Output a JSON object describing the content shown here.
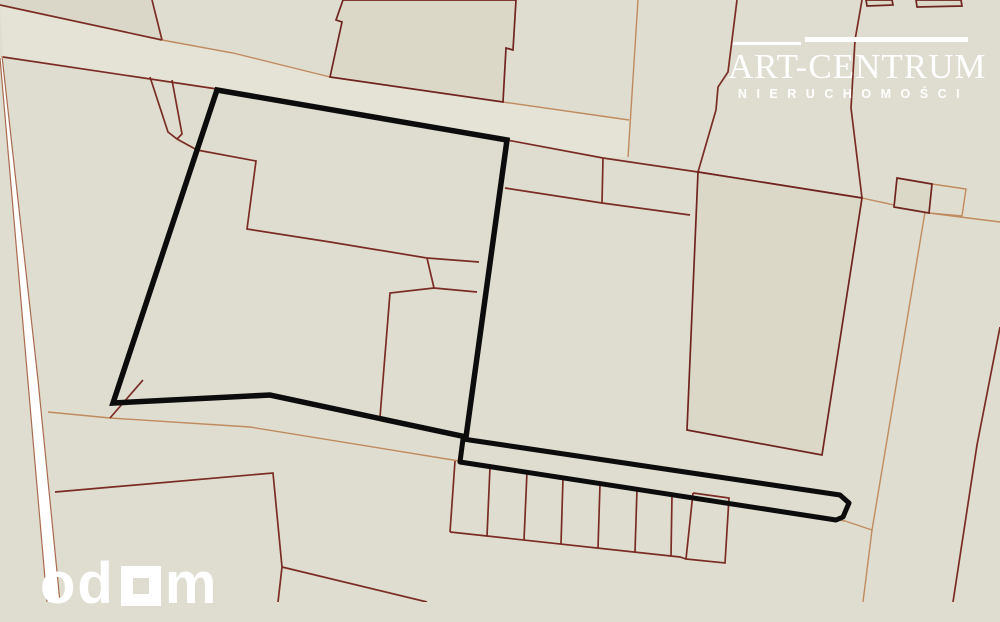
{
  "watermarks": {
    "brand": {
      "title": "ART-CENTRUM",
      "subtitle": "NIERUCHOMOŚCI"
    },
    "portal": {
      "prefix": "od",
      "suffix": "m"
    }
  },
  "map": {
    "canvas": {
      "width": 1000,
      "height": 602
    },
    "colors": {
      "background": "#dfddcf",
      "parcel_dark_line": "#7a2c24",
      "building_line": "#6f241f",
      "building_fill": "#dbd8c7",
      "tan_line": "#c08a5f",
      "road_white": "#ffffff",
      "road_edge": "#a96a4f",
      "highlight": "#0c0c0c",
      "parcel_fill_dark": "#dad7c8",
      "road_band_fill": "#e5e3d5"
    },
    "fills": [
      {
        "name": "parcel-topleft-fill",
        "fill": "#dad7c8",
        "pts": [
          [
            0,
            0
          ],
          [
            152,
            0
          ],
          [
            162,
            40
          ],
          [
            0,
            5
          ]
        ]
      },
      {
        "name": "road-band-fill",
        "fill": "#e5e3d5",
        "pts": [
          [
            0,
            5
          ],
          [
            162,
            40
          ],
          [
            233,
            53
          ],
          [
            330,
            77
          ],
          [
            503,
            102
          ],
          [
            629,
            120
          ],
          [
            628,
            157
          ],
          [
            603,
            158
          ],
          [
            507,
            140
          ],
          [
            217,
            89
          ],
          [
            3,
            57
          ]
        ]
      }
    ],
    "white_road": {
      "fill_pts": [
        [
          0,
          58
        ],
        [
          2,
          56
        ],
        [
          38,
          380
        ],
        [
          60,
          602
        ],
        [
          47,
          602
        ],
        [
          28,
          382
        ]
      ],
      "edges": [
        {
          "name": "white-road-edge-right",
          "pts": [
            [
              2,
              56
            ],
            [
              38,
              380
            ],
            [
              60,
              602
            ]
          ]
        },
        {
          "name": "white-road-edge-left",
          "pts": [
            [
              0,
              58
            ],
            [
              28,
              382
            ],
            [
              47,
              602
            ]
          ]
        }
      ]
    },
    "tan_lines": [
      {
        "name": "road-upper-edge-west",
        "pts": [
          [
            162,
            40
          ],
          [
            233,
            53
          ],
          [
            330,
            77
          ]
        ]
      },
      {
        "name": "road-upper-edge-east",
        "pts": [
          [
            503,
            102
          ],
          [
            629,
            120
          ]
        ]
      },
      {
        "name": "north-vertical-divider",
        "pts": [
          [
            638,
            0
          ],
          [
            628,
            157
          ]
        ]
      },
      {
        "name": "block-top-line-east",
        "pts": [
          [
            862,
            198
          ],
          [
            894,
            205
          ],
          [
            929,
            213
          ],
          [
            1000,
            222
          ]
        ]
      },
      {
        "name": "east-parcel-divider",
        "pts": [
          [
            925,
            212
          ],
          [
            887,
            440
          ],
          [
            872,
            530
          ],
          [
            863,
            602
          ]
        ]
      },
      {
        "name": "strip-end-connector",
        "pts": [
          [
            845,
            521
          ],
          [
            872,
            530
          ]
        ]
      },
      {
        "name": "south-road-line",
        "pts": [
          [
            48,
            412
          ],
          [
            110,
            418
          ],
          [
            250,
            427
          ],
          [
            453,
            460
          ],
          [
            845,
            521
          ]
        ]
      },
      {
        "name": "tan-square-parcel",
        "pts": [
          [
            932,
            184
          ],
          [
            966,
            189
          ],
          [
            962,
            216
          ],
          [
            929,
            213
          ],
          [
            932,
            184
          ]
        ]
      }
    ],
    "dark_lines": [
      {
        "name": "topleft-parcel-boundary",
        "pts": [
          [
            0,
            5
          ],
          [
            162,
            40
          ]
        ]
      },
      {
        "name": "topleft-vertical",
        "pts": [
          [
            152,
            0
          ],
          [
            162,
            40
          ]
        ]
      },
      {
        "name": "road-lower-edge",
        "pts": [
          [
            3,
            57
          ],
          [
            217,
            89
          ]
        ]
      },
      {
        "name": "block-top-line",
        "pts": [
          [
            217,
            89
          ],
          [
            507,
            140
          ],
          [
            603,
            158
          ],
          [
            698,
            172
          ],
          [
            862,
            198
          ]
        ]
      },
      {
        "name": "northeast-parcel-line",
        "pts": [
          [
            737,
            0
          ],
          [
            728,
            72
          ],
          [
            718,
            87
          ],
          [
            716,
            110
          ],
          [
            698,
            172
          ]
        ]
      },
      {
        "name": "east-boundary-upper",
        "pts": [
          [
            862,
            0
          ],
          [
            855,
            40
          ],
          [
            851,
            108
          ],
          [
            862,
            198
          ]
        ]
      },
      {
        "name": "small-rect-divider",
        "pts": [
          [
            603,
            158
          ],
          [
            602,
            203
          ]
        ]
      },
      {
        "name": "small-rect-bottom",
        "pts": [
          [
            505,
            188
          ],
          [
            602,
            203
          ],
          [
            690,
            215
          ]
        ]
      },
      {
        "name": "house-parcel-line",
        "pts": [
          [
            197,
            150
          ],
          [
            256,
            161
          ],
          [
            247,
            229
          ],
          [
            330,
            242
          ],
          [
            427,
            258
          ],
          [
            434,
            288
          ],
          [
            390,
            293
          ],
          [
            380,
            417
          ]
        ]
      },
      {
        "name": "house-parcel-stub-a",
        "pts": [
          [
            427,
            258
          ],
          [
            479,
            262
          ]
        ]
      },
      {
        "name": "house-parcel-stub-b",
        "pts": [
          [
            434,
            288
          ],
          [
            477,
            292
          ]
        ]
      },
      {
        "name": "funnel-left",
        "pts": [
          [
            150,
            77
          ],
          [
            168,
            132
          ],
          [
            177,
            139
          ],
          [
            197,
            150
          ]
        ]
      },
      {
        "name": "funnel-right",
        "pts": [
          [
            172,
            80
          ],
          [
            182,
            134
          ],
          [
            177,
            139
          ]
        ]
      },
      {
        "name": "southwest-cross-line",
        "pts": [
          [
            143,
            380
          ],
          [
            110,
            418
          ]
        ]
      },
      {
        "name": "southwest-boundary",
        "pts": [
          [
            55,
            492
          ],
          [
            273,
            473
          ],
          [
            282,
            567
          ]
        ]
      },
      {
        "name": "southwest-branch-a",
        "pts": [
          [
            282,
            567
          ],
          [
            427,
            602
          ]
        ]
      },
      {
        "name": "southwest-branch-b",
        "pts": [
          [
            282,
            567
          ],
          [
            278,
            602
          ]
        ]
      },
      {
        "name": "east-lower-boundary",
        "pts": [
          [
            1000,
            327
          ],
          [
            977,
            445
          ],
          [
            953,
            602
          ]
        ]
      },
      {
        "name": "garage-left-edge",
        "pts": [
          [
            455,
            461
          ],
          [
            450,
            532
          ]
        ]
      },
      {
        "name": "garage-divider-1",
        "pts": [
          [
            490,
            467
          ],
          [
            487,
            536
          ]
        ]
      },
      {
        "name": "garage-divider-2",
        "pts": [
          [
            527,
            472
          ],
          [
            524,
            540
          ]
        ]
      },
      {
        "name": "garage-divider-3",
        "pts": [
          [
            563,
            478
          ],
          [
            561,
            544
          ]
        ]
      },
      {
        "name": "garage-divider-4",
        "pts": [
          [
            600,
            484
          ],
          [
            598,
            548
          ]
        ]
      },
      {
        "name": "garage-divider-5",
        "pts": [
          [
            637,
            489
          ],
          [
            635,
            552
          ]
        ]
      },
      {
        "name": "garage-divider-6",
        "pts": [
          [
            672,
            495
          ],
          [
            671,
            556
          ]
        ]
      },
      {
        "name": "garage-bottom-edge",
        "pts": [
          [
            450,
            532
          ],
          [
            680,
            557
          ],
          [
            686,
            559
          ]
        ]
      },
      {
        "name": "garage-end-box",
        "pts": [
          [
            693,
            493
          ],
          [
            729,
            498
          ],
          [
            725,
            563
          ],
          [
            686,
            559
          ],
          [
            693,
            493
          ]
        ]
      }
    ],
    "buildings": [
      {
        "name": "building-top-center",
        "pts": [
          [
            343,
            0
          ],
          [
            336,
            20
          ],
          [
            342,
            22
          ],
          [
            330,
            77
          ],
          [
            503,
            102
          ],
          [
            506,
            48
          ],
          [
            513,
            50
          ],
          [
            516,
            0
          ]
        ]
      },
      {
        "name": "building-east-large",
        "pts": [
          [
            698,
            172
          ],
          [
            862,
            198
          ],
          [
            822,
            455
          ],
          [
            687,
            430
          ]
        ]
      },
      {
        "name": "building-small-square",
        "pts": [
          [
            897,
            178
          ],
          [
            932,
            184
          ],
          [
            929,
            213
          ],
          [
            894,
            207
          ]
        ]
      },
      {
        "name": "building-top-sliver-a",
        "pts": [
          [
            866,
            0
          ],
          [
            892,
            0
          ],
          [
            893,
            5
          ],
          [
            867,
            6
          ]
        ]
      },
      {
        "name": "building-top-sliver-b",
        "pts": [
          [
            916,
            0
          ],
          [
            961,
            0
          ],
          [
            962,
            6
          ],
          [
            917,
            7
          ]
        ]
      }
    ],
    "highlight": {
      "main_parcel": [
        [
          217,
          90
        ],
        [
          507,
          140
        ],
        [
          466,
          437
        ],
        [
          270,
          395
        ],
        [
          113,
          403
        ]
      ],
      "strip_parcel": [
        [
          463,
          439
        ],
        [
          840,
          495
        ],
        [
          849,
          503
        ],
        [
          843,
          517
        ],
        [
          836,
          520
        ],
        [
          460,
          462
        ]
      ]
    }
  }
}
